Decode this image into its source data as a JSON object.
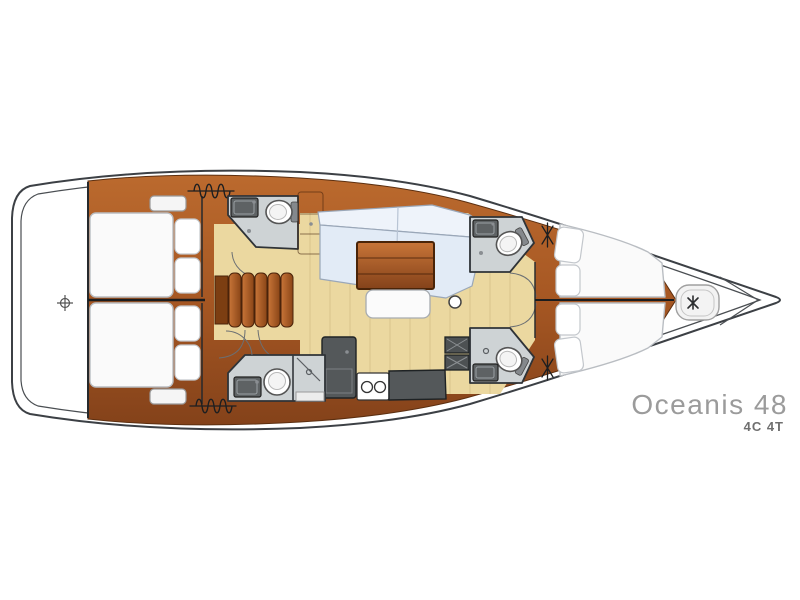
{
  "title": {
    "model": "Oceanis 48",
    "configuration": "4C 4T"
  },
  "colors": {
    "outline": "#3c4045",
    "wood_light": "#bb6a2e",
    "wood_mid": "#a65723",
    "wood_dark": "#84421a",
    "floor": "#ebd8a0",
    "head_floor": "#ced3d5",
    "counter": "#54585a",
    "sofa": "#e2ebf6",
    "sofa_back": "#eef3fa",
    "mattress": "#fafafa",
    "stair_light": "#c87538",
    "stair_dark": "#8a4517",
    "text_model": "#9b9b9b",
    "text_config": "#6f6f6f"
  },
  "icons": {
    "stern_marker": "crosshair-icon",
    "steering_gear": "zigzag-coil-icon",
    "deck_hatch": "bowtie-hatch-icon",
    "anchor_windlass": "anchor-windlass-icon",
    "mast": "mast-post",
    "stove": "twin-burner-icon",
    "shower": "shower-head-icon"
  }
}
